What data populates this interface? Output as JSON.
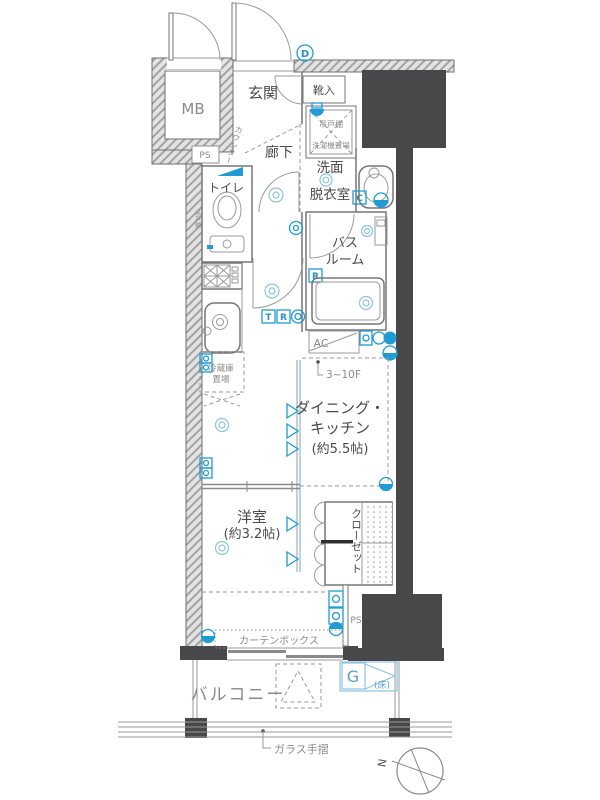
{
  "colors": {
    "wall_dark": "#48484b",
    "hatch_line": "#a3a3a3",
    "hatch_bg": "#e3e3e3",
    "outline": "#767676",
    "accent_blue": "#1f9cd5",
    "light_blue": "#8cc3de",
    "text": "#4a4a4a",
    "text_muted": "#8a8a8a"
  },
  "plan": {
    "mb": "MB",
    "entrance": "玄関",
    "shoe_cabinet": "靴入",
    "ps_upper": "PS",
    "counter": "カウンター",
    "corridor": "廊下",
    "laundry": {
      "shelf": "吊戸棚",
      "washer": "洗濯機置場"
    },
    "washroom": {
      "line1": "洗面",
      "line2": "脱衣室"
    },
    "toilet": {
      "name": "トイレ",
      "shelf": "吊戸棚"
    },
    "bathroom": {
      "line1": "バス",
      "line2": "ルーム"
    },
    "ac": "AC",
    "floor_note": "3~10F",
    "fridge": {
      "line1": "冷蔵庫",
      "line2": "置場"
    },
    "dining_kitchen": {
      "line1": "ダイニング・",
      "line2": "キッチン",
      "line3": "(約5.5帖)"
    },
    "western_room": {
      "line1": "洋室",
      "line2": "(約3.2帖)"
    },
    "closet": "クローゼット",
    "ps_lower": "PS",
    "curtain_box": "カーテンボックス",
    "balcony": "バルコニー",
    "gas": {
      "letter": "G",
      "note": "(床)"
    },
    "glass_rail": "ガラス手摺",
    "compass_north": "N",
    "symbols": {
      "d": "D",
      "c": "C",
      "r_bath": "R",
      "t_hall": "T",
      "r_hall": "R"
    }
  }
}
